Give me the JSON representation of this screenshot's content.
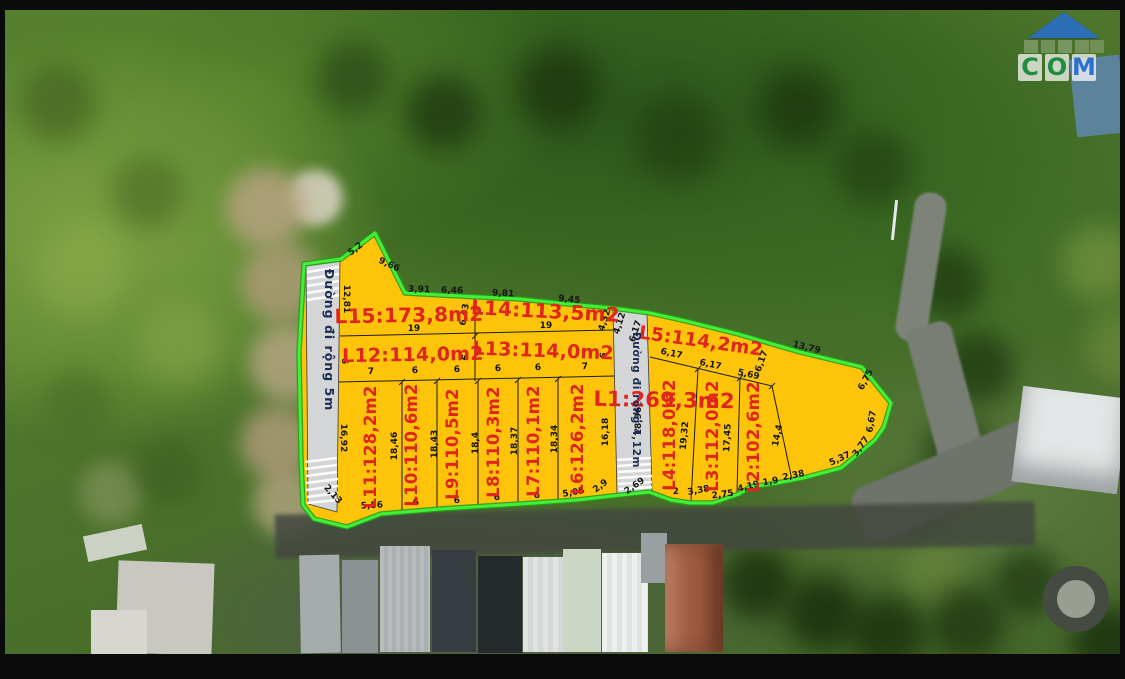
{
  "watermark": {
    "letters": [
      "C",
      "O",
      "M"
    ]
  },
  "roads": {
    "road1_label": "Đường đi rộng 5m",
    "road2_label": "Đường đi rộng 4,12m"
  },
  "plots": {
    "L1": "L1:269,3m2",
    "L2": "L2:102,6m2",
    "L3": "L3:112,0m2",
    "L4": "L4:118,0m2",
    "L5": "L5:114,2m2",
    "L6": "L6:126,2m2",
    "L7": "L7:110,1m2",
    "L8": "L8:110,3m2",
    "L9": "L9:110,5m2",
    "L10": "L10:110,6m2",
    "L11": "L11:128,2m2",
    "L12": "L12:114,0m2",
    "L13": "L13:114,0m2",
    "L14": "L14:113,5m2",
    "L15": "L15:173,8m2"
  },
  "dims": {
    "apex": [
      "5,2",
      "9,66"
    ],
    "l15_top": [
      "3,91",
      "6,46"
    ],
    "l14_top": [
      "9,81",
      "9,45"
    ],
    "row1_width": [
      "19",
      "19"
    ],
    "divider_l15_l14": "6,43",
    "divider_l12_l13": "6",
    "l13_right": "6",
    "row2_widths": [
      "7",
      "6",
      "6",
      "6",
      "6",
      "7"
    ],
    "road1": [
      "12,81",
      "6",
      "16,92",
      "2,13"
    ],
    "bottom_left": [
      "5,56",
      "6",
      "6",
      "6",
      "6",
      "5,05",
      "2,9"
    ],
    "plot_depths_left": [
      "18,46",
      "18,43",
      "18,4",
      "18,37",
      "18,34"
    ],
    "road2": [
      "4,32",
      "4,12",
      "6,17",
      "18,96",
      "16,18",
      "2,69"
    ],
    "l5_top": "13,79",
    "l5_bottom": [
      "6,17",
      "6,17",
      "5,69",
      "6,17"
    ],
    "right_depths": [
      "19,32",
      "17,45",
      "14,4"
    ],
    "right_edge": [
      "6,75",
      "6,67"
    ],
    "bottom_right": [
      "2",
      "3,38",
      "2,75",
      "4,19",
      "1,9",
      "2,38",
      "5,37",
      "3,77"
    ]
  },
  "colors": {
    "plot_fill": "#fdc40a",
    "boundary_green": "#45ef39",
    "label_red": "#e0261c",
    "road_fill": "#d4d5d6",
    "road_label_navy": "#1d2c55",
    "watermark_green": "#1d8f44",
    "watermark_blue": "#2b6fd4"
  }
}
